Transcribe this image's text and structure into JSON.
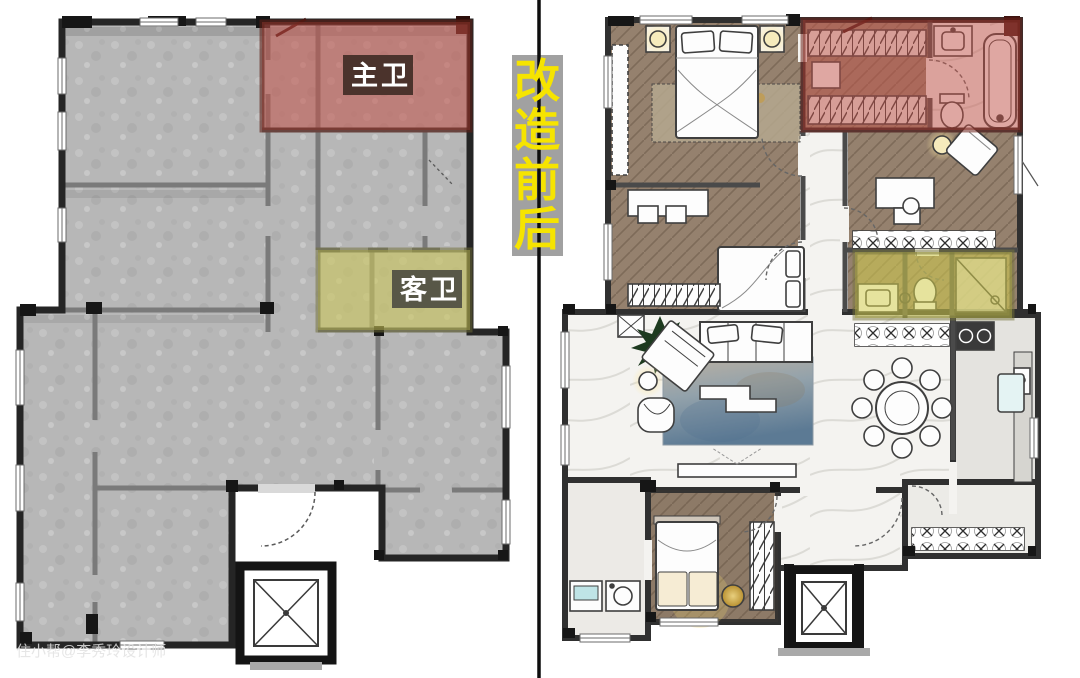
{
  "divider": {
    "chars": [
      "改",
      "造",
      "前",
      "后"
    ],
    "badge_bg": "#a1a1a1",
    "char_color": "#f6e400",
    "line_color": "#0d0d0d"
  },
  "before_plan": {
    "labels": {
      "master_bath": "主卫",
      "guest_bath": "客卫"
    },
    "colors": {
      "master_bath_highlight": "#c25248",
      "guest_bath_highlight": "#ccc65c",
      "master_bath_label_bg": "#4b332c",
      "guest_bath_label_bg": "#585747",
      "label_text": "#ffffff",
      "floor": "#b7b7b7",
      "walls": "#2a2a2a"
    }
  },
  "after_plan": {
    "colors": {
      "master_bath_highlight": "#c25248",
      "guest_bath_highlight": "#d3cd4e",
      "wood_floor": "#95816e",
      "marble_floor": "#f4f3f0",
      "walls": "#333333",
      "rug_blue": "#5c7a94",
      "accent_gold": "#d9b658"
    }
  },
  "watermark": {
    "text": "住小帮@李秀玲设计师",
    "color": "#e2e2e2"
  }
}
